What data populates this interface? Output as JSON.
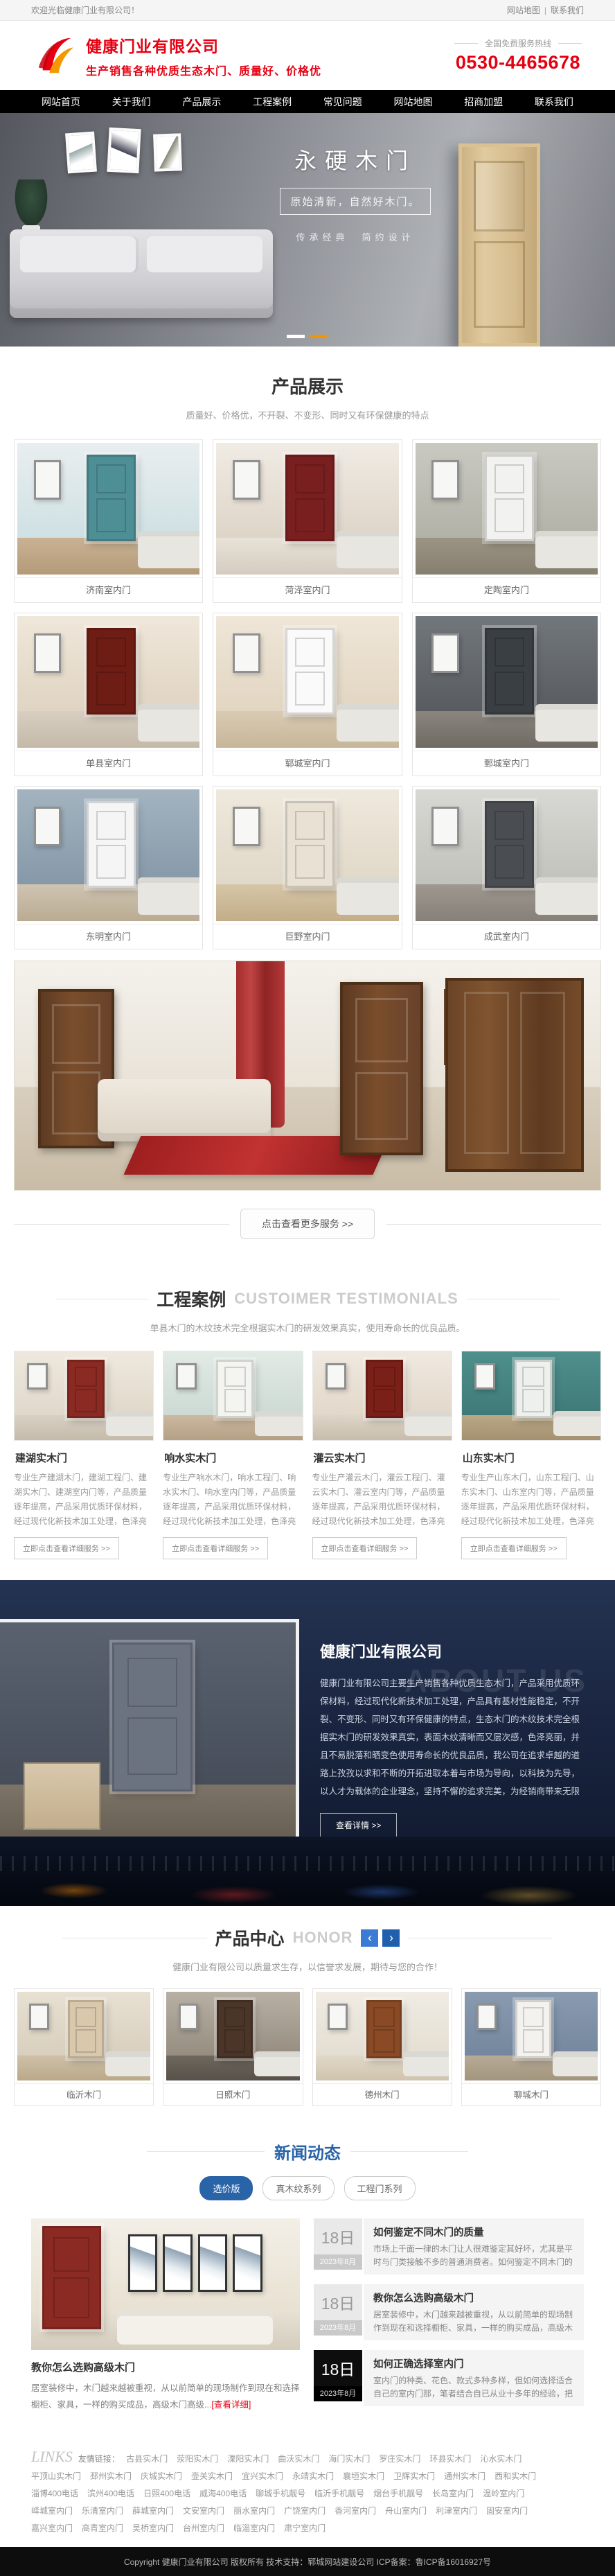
{
  "colors": {
    "accent_red": "#e60012",
    "accent_blue": "#2a64a8",
    "nav_bg": "#000000",
    "banner_dot_active": "#f29600"
  },
  "topbar": {
    "welcome": "欢迎光临健康门业有限公司！",
    "sitemap": "网站地图",
    "divider": "|",
    "contact": "联系我们"
  },
  "header": {
    "company_name": "健康门业有限公司",
    "slogan": "生产销售各种优质生态木门、质量好、价格优",
    "hotline_label": "全国免费服务热线",
    "phone": "0530-4465678"
  },
  "nav": {
    "items": [
      "网站首页",
      "关于我们",
      "产品展示",
      "工程案例",
      "常见问题",
      "网站地图",
      "招商加盟",
      "联系我们"
    ]
  },
  "banner": {
    "title": "永硬木门",
    "subtitle": "原始清新，自然好木门。",
    "tagline": "传承经典　简约设计"
  },
  "products": {
    "title": "产品展示",
    "subtitle": "质量好、价格优，不开裂、不变形、同时又有环保健康的特点",
    "items": [
      "济南室内门",
      "菏泽室内门",
      "定陶室内门",
      "单县室内门",
      "郓城室内门",
      "鄄城室内门",
      "东明室内门",
      "巨野室内门",
      "成武室内门"
    ],
    "more_label": "点击查看更多服务 >>"
  },
  "cases": {
    "title": "工程案例",
    "title_en": "CUSTOIMER TESTIMONIALS",
    "subtitle": "单县木门的木纹技术完全根据实木门的研发效果真实，使用寿命长的优良品质。",
    "link_label": "立即点击查看详细服务 >>",
    "items": [
      {
        "name": "建湖实木门",
        "desc": "专业生产建湖木门，建湖工程门、建湖实木门、建湖室内门等，产品质量逐年提高，产品采用优质环保材料，经过现代化新技术加工处理，色泽亮丽，不易脱落。"
      },
      {
        "name": "响水实木门",
        "desc": "专业生产响水木门，响水工程门、响水实木门、响水室内门等，产品质量逐年提高，产品采用优质环保材料，经过现代化新技术加工处理，色泽亮丽，不易脱落。"
      },
      {
        "name": "灌云实木门",
        "desc": "专业生产灌云木门，灌云工程门、灌云实木门、灌云室内门等，产品质量逐年提高，产品采用优质环保材料，经过现代化新技术加工处理，色泽亮丽，不易脱落。"
      },
      {
        "name": "山东实木门",
        "desc": "专业生产山东木门，山东工程门、山东实木门、山东室内门等，产品质量逐年提高，产品采用优质环保材料，经过现代化新技术加工处理，色泽亮丽，不易脱落。"
      }
    ]
  },
  "about": {
    "title": "健康门业有限公司",
    "title_en": "ABOUT US",
    "paragraph": "健康门业有限公司主要生产销售各种优质生态木门，产品采用优质环保材料，经过现代化新技术加工处理，产品具有基材性能稳定，不开裂、不变形、同时又有环保健康的特点，生态木门的木纹技术完全根据实木门的研发效果真实，表面木纹清晰而又层次感，色泽亮丽，并且不易脱落和晒变色使用寿命长的优良品质，我公司在追求卓越的道路上孜孜以求和不断的开拓进取本着与市场为导向，以科技为先导，以人才为载体的企业理念，坚持不懈的追求完美，为经销商带来无限商机和利益。",
    "button": "查看详情 >>"
  },
  "honor": {
    "title": "产品中心",
    "title_en": "HONOR",
    "prev": "‹",
    "next": "›",
    "subtitle": "健康门业有限公司以质量求生存，以信誉求发展，期待与您的合作！",
    "items": [
      "临沂木门",
      "日照木门",
      "德州木门",
      "聊城木门"
    ]
  },
  "news": {
    "title": "新闻动态",
    "tabs": [
      "选价版",
      "真木纹系列",
      "工程门系列"
    ],
    "featured": {
      "title": "教你怎么选购高级木门",
      "excerpt": "居室装修中，木门越来越被重视，从以前简单的现场制作到现在和选择橱柜、家具，一样的购买成品，高级木门高级...",
      "more": "[查看详细]"
    },
    "items": [
      {
        "day": "18日",
        "month": "2023年8月",
        "title": "如何鉴定不同木门的质量",
        "excerpt": "市场上千面一律的木门让人很难鉴定其好坏，尤其是平时与门类接触不多的普通消费者。如何鉴定不同木门的质量？..."
      },
      {
        "day": "18日",
        "month": "2023年8月",
        "title": "教你怎么选购高级木门",
        "excerpt": "居室装修中，木门越来越被重视，从以前简单的现场制作到现在和选择橱柜、家具，一样的购买成品，高级木门高级..."
      },
      {
        "day": "18日",
        "month": "2023年8月",
        "title": "如何正确选择室内门",
        "excerpt": "室内门的种类、花色、款式多种多样，但如何选择适合自己的室内门那，笔者结合自已从业十多年的经验，把自己的..."
      }
    ]
  },
  "footer": {
    "links_label_en": "LINKS",
    "links_label": "友情链接：",
    "links": [
      "古县实木门",
      "荥阳实木门",
      "溧阳实木门",
      "曲沃实木门",
      "海门实木门",
      "罗庄实木门",
      "环县实木门",
      "沁水实木门",
      "平顶山实木门",
      "邳州实木门",
      "庆城实木门",
      "壶关实木门",
      "宜兴实木门",
      "永靖实木门",
      "襄垣实木门",
      "卫辉实木门",
      "通州实木门",
      "西和实木门",
      "淄博400电话",
      "滨州400电话",
      "日照400电话",
      "威海400电话",
      "聊城手机靓号",
      "临沂手机靓号",
      "烟台手机靓号",
      "长岛室内门",
      "温岭室内门",
      "峄城室内门",
      "乐清室内门",
      "薛城室内门",
      "文安室内门",
      "丽水室内门",
      "广饶室内门",
      "香河室内门",
      "舟山室内门",
      "利津室内门",
      "固安室内门",
      "嘉兴室内门",
      "高青室内门",
      "吴桥室内门",
      "台州室内门",
      "临淄室内门",
      "肃宁室内门"
    ],
    "copyright": "Copyright  健康门业有限公司  版权所有  技术支持：郓城网站建设公司   ICP备案：鲁ICP备16016927号"
  }
}
